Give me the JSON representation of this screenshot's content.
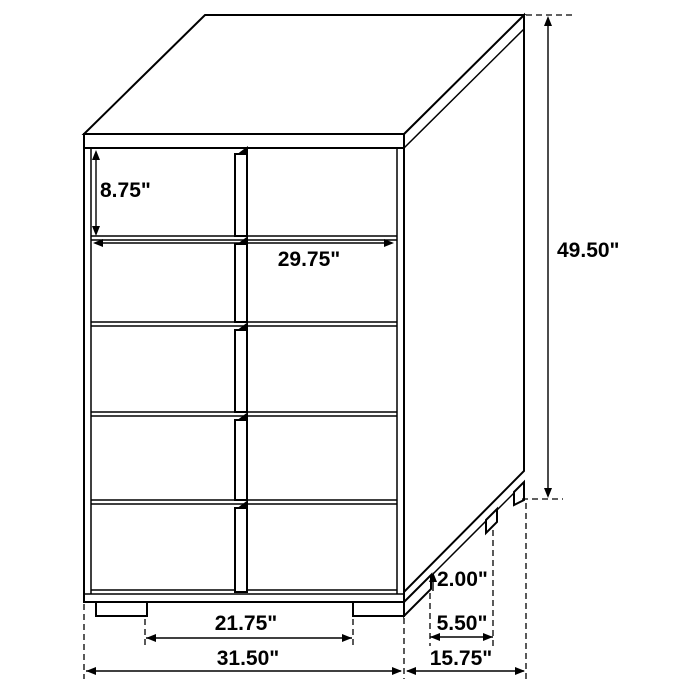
{
  "diagram": {
    "subject": "Five-drawer chest dimension drawing, three-quarter oblique view",
    "structure": {
      "drawer_rows": 5,
      "drawer_columns": 2,
      "front_legs": 2
    },
    "colors": {
      "line": "#000000",
      "text": "#000000",
      "background": "#ffffff"
    },
    "labels": {
      "top_drawer_height": "8.75\"",
      "drawer_front_width": "29.75\"",
      "overall_height": "49.50\"",
      "leg_height": "2.00\"",
      "side_leg_spacing": "5.50\"",
      "front_leg_spacing": "21.75\"",
      "overall_width": "31.50\"",
      "overall_depth": "15.75\""
    }
  }
}
